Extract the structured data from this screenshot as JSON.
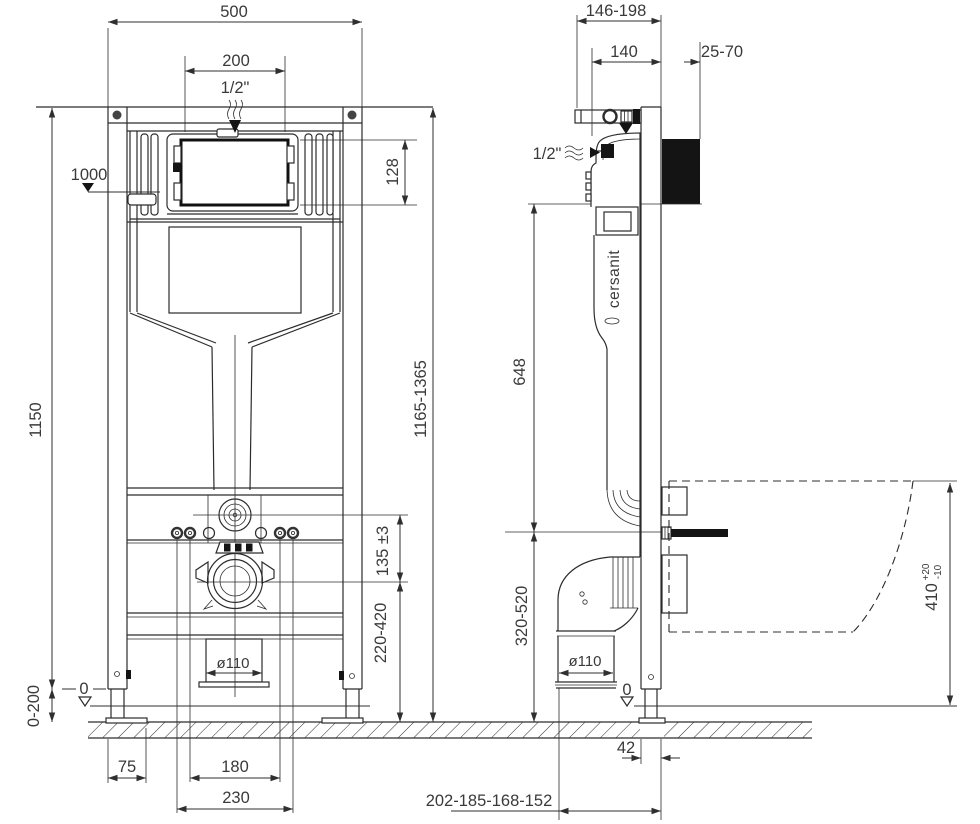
{
  "front_view": {
    "overall_width": "500",
    "flush_opening_width": "200",
    "water_inlet": "1/2\"",
    "level_1000": "1000",
    "flush_opening_height": "128",
    "frame_height": "1150",
    "total_height_range": "1165-1365",
    "water_drain_offset": "135 ±3",
    "drain_height_range": "220-420",
    "feet_adjustment": "0-200",
    "level_zero": "0",
    "drain_diameter": "ø110",
    "foot_edge_offset": "75",
    "bolt_spacing_inner": "180",
    "bolt_spacing_outer": "230"
  },
  "side_view": {
    "depth_range": "146-198",
    "frame_depth": "140",
    "wall_finish_range": "25-70",
    "water_inlet": "1/2\"",
    "brand": "cersanit",
    "plate_to_axis_height": "648",
    "drain_axis_height_range": "320-520",
    "drain_diameter": "ø110",
    "level_zero": "0",
    "bowl_height_value": "410",
    "bowl_height_tol_plus": "+20",
    "bowl_height_tol_minus": "-10",
    "profile_depth": "42",
    "drain_offset_options": "202-185-168-152"
  },
  "colors": {
    "line": "#2c2c2c",
    "text": "#3a3a3a",
    "black_fill": "#141414",
    "background": "#ffffff"
  }
}
